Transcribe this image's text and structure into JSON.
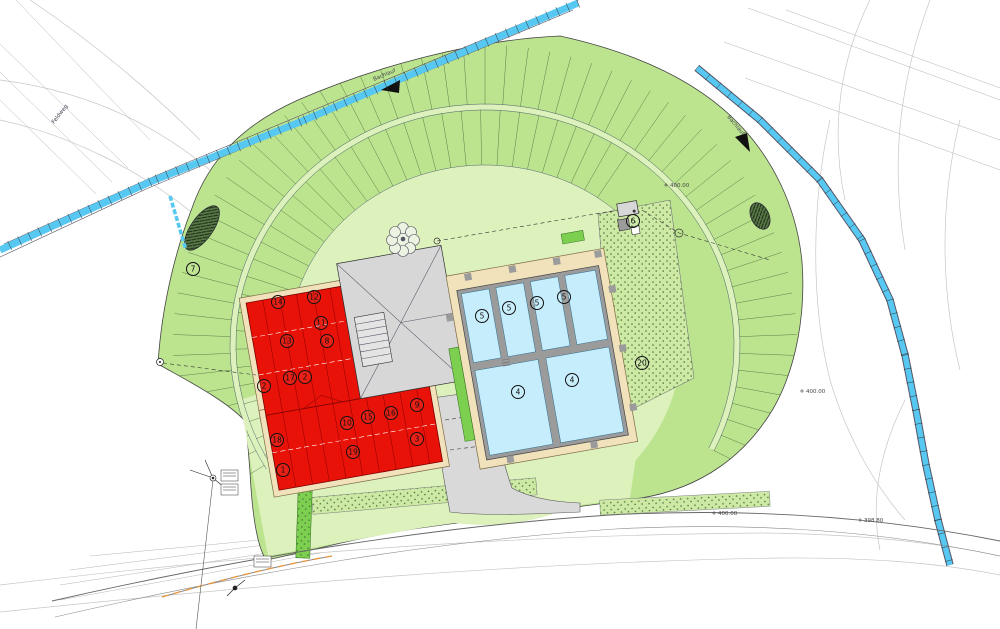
{
  "plan": {
    "title": "site-plan",
    "markers": [
      {
        "n": "7",
        "x": 193,
        "y": 269
      },
      {
        "n": "2",
        "x": 264,
        "y": 386
      },
      {
        "n": "6",
        "x": 633,
        "y": 221
      },
      {
        "n": "20",
        "x": 642,
        "y": 363
      },
      {
        "n": "14",
        "x": 278,
        "y": 302
      },
      {
        "n": "12",
        "x": 314,
        "y": 297
      },
      {
        "n": "11",
        "x": 321,
        "y": 323
      },
      {
        "n": "13",
        "x": 287,
        "y": 341
      },
      {
        "n": "8",
        "x": 327,
        "y": 341
      },
      {
        "n": "17",
        "x": 290,
        "y": 378
      },
      {
        "n": "2",
        "x": 305,
        "y": 377
      },
      {
        "n": "18",
        "x": 277,
        "y": 440
      },
      {
        "n": "1",
        "x": 283,
        "y": 470
      },
      {
        "n": "10",
        "x": 347,
        "y": 423
      },
      {
        "n": "19",
        "x": 353,
        "y": 452
      },
      {
        "n": "15",
        "x": 368,
        "y": 417
      },
      {
        "n": "16",
        "x": 391,
        "y": 413
      },
      {
        "n": "9",
        "x": 417,
        "y": 405
      },
      {
        "n": "3",
        "x": 417,
        "y": 439
      },
      {
        "n": "5",
        "x": 482,
        "y": 316
      },
      {
        "n": "5",
        "x": 509,
        "y": 308
      },
      {
        "n": "5",
        "x": 537,
        "y": 303
      },
      {
        "n": "5",
        "x": 564,
        "y": 297
      },
      {
        "n": "4",
        "x": 518,
        "y": 392
      },
      {
        "n": "4",
        "x": 572,
        "y": 380
      }
    ],
    "elevations": [
      {
        "t": "400.00",
        "x": 670,
        "y": 187
      },
      {
        "t": "400.00",
        "x": 806,
        "y": 393
      },
      {
        "t": "400.00",
        "x": 718,
        "y": 515
      },
      {
        "t": "398.80",
        "x": 864,
        "y": 522
      }
    ],
    "stream_labels": [
      {
        "t": "Bachlauf",
        "x": 374,
        "y": 81,
        "r": -23
      },
      {
        "t": "Bachlauf",
        "x": 727,
        "y": 117,
        "r": 50
      },
      {
        "t": "Feldweg",
        "x": 54,
        "y": 124,
        "r": -52
      }
    ],
    "colors": {
      "band": "#bce48f",
      "infield": "#ddf1bc",
      "hedge": "#7ccf4f",
      "building": "#e91208",
      "roof": "#d7d7d7",
      "pool": "#c6edfb",
      "deck": "#f1e2bc",
      "wall": "#9b9b9b",
      "stream": "#57c8f2"
    }
  }
}
